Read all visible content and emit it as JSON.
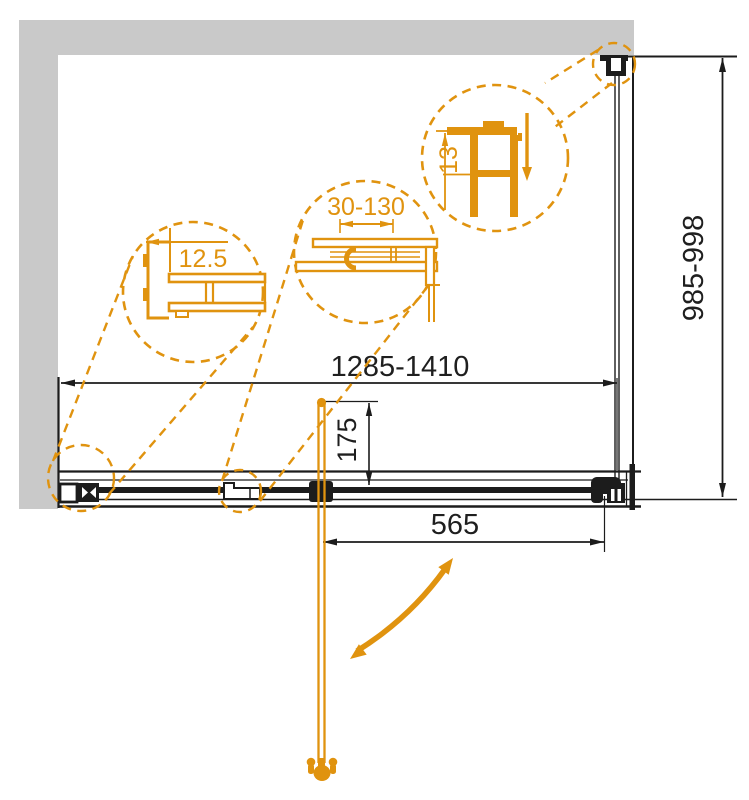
{
  "drawing": {
    "dimensions": {
      "width_range": "1285-1410",
      "height_range": "985-998",
      "door_width": "565",
      "handle_height": "175"
    },
    "details": {
      "left_profile": "12.5",
      "middle_adjustment": "30-130",
      "right_wall_profile": "13"
    },
    "colors": {
      "accent_orange": "#e0930f",
      "wall_gray": "#c9c9c9",
      "line_black": "#1c1c1c"
    }
  }
}
